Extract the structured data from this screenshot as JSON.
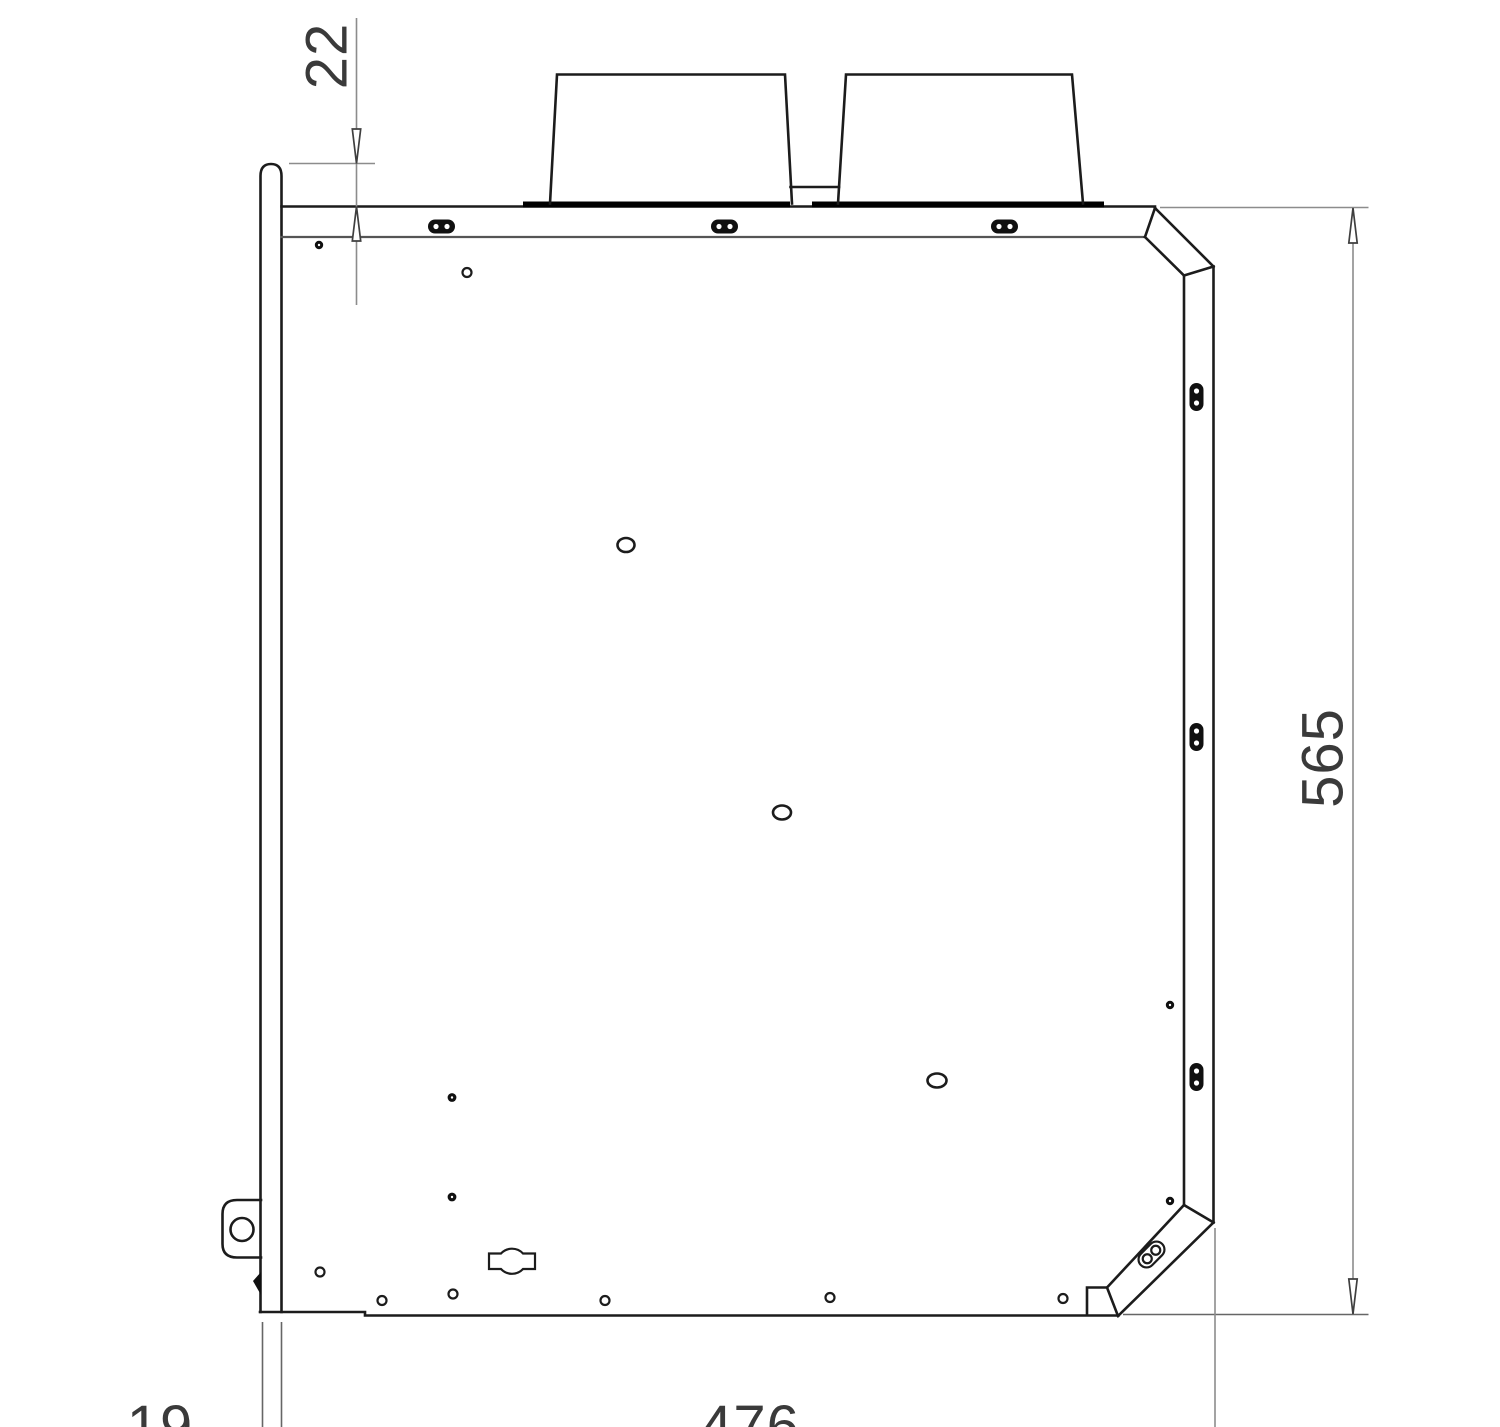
{
  "drawing": {
    "type": "technical-drawing-side-view",
    "dimension_labels": {
      "top_flange_offset": "22",
      "overall_height": "565",
      "flange_width": "19",
      "overall_width": "476"
    }
  },
  "colors": {
    "background": "#ffffff",
    "outline": "#1c1c1c",
    "edge-mid": "#555555",
    "thick": "#000000",
    "dim": "#8c8c8c",
    "text": "#3a3a3a"
  }
}
